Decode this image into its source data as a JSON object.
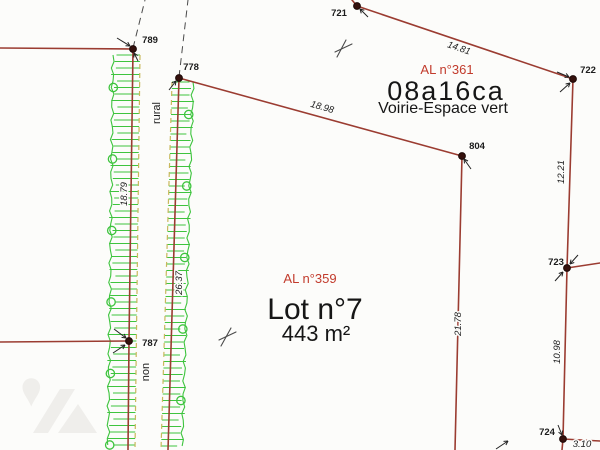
{
  "plan": {
    "points": {
      "p789": "789",
      "p778": "778",
      "p721": "721",
      "p722": "722",
      "p804": "804",
      "p723": "723",
      "p724": "724",
      "p787": "787"
    },
    "measurements": {
      "m1481": "14.81",
      "m1898": "18.98",
      "m1221": "12.21",
      "m2178": "21.78",
      "m1098": "10.98",
      "m310": "3.10",
      "m1879": "18.79",
      "m2637": "26.37"
    },
    "zone361": {
      "code": "AL n°361",
      "area": "08a16ca",
      "desc": "Voirie-Espace vert"
    },
    "lot": {
      "code": "AL n°359",
      "name": "Lot n°7",
      "area": "443 m²"
    },
    "path_labels": {
      "rural": "rural",
      "non": "non"
    },
    "colors": {
      "boundary": "#9b3c31",
      "hedge_green": "#3ec43e",
      "olive_dash": "#c9b85c",
      "red_label": "#c23b2c"
    }
  }
}
